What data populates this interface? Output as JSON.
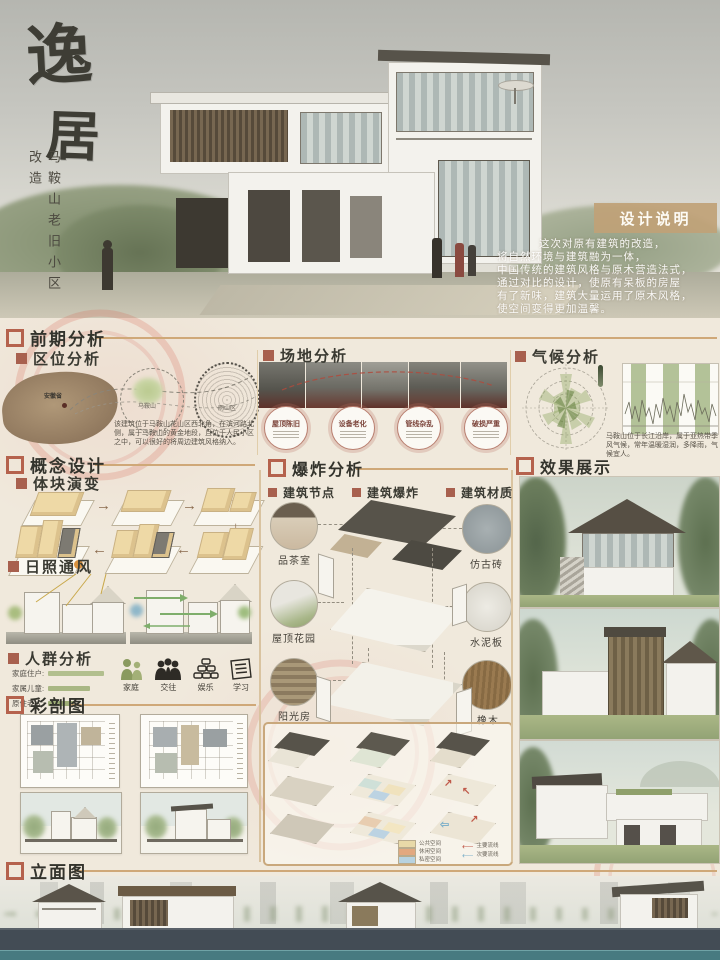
{
  "hero": {
    "title_chars": [
      "逸",
      "居"
    ],
    "subtitle": "马鞍山老旧小区改造",
    "design_note_title": "设计说明",
    "design_note_lines": [
      "这次对原有建筑的改造，",
      "将自然环境与建筑融为一体，",
      "中国传统的建筑风格与原木营造法式，",
      "通过对比的设计，使原有呆板的房屋",
      "有了新味，建筑大量运用了原木风格，",
      "使空间变得更加温馨。"
    ]
  },
  "sections": {
    "preliminary": {
      "title": "前期分析",
      "location": {
        "title": "区位分析",
        "map_labels": [
          "安徽省",
          "马鞍山",
          "雨山区"
        ],
        "desc": "该建筑位于马鞍山花山区西北角，在滨河路北侧，属于马鞍山的黄金地段，且位于人民小区之中，可以很好的将周边建筑风格纳入。"
      },
      "site": {
        "title": "场地分析",
        "issues": [
          "屋顶陈旧",
          "设备老化",
          "管线杂乱",
          "破损严重"
        ]
      },
      "climate": {
        "title": "气候分析",
        "desc": "马鞍山位于长江沿岸，属于亚热带季风气候，常年温暖湿润，多降雨，气候宜人。"
      }
    },
    "concept": {
      "title": "概念设计",
      "massing": {
        "title": "体块演变",
        "arrows": [
          "→",
          "→",
          "↓",
          "←",
          "←"
        ]
      },
      "sunwind": {
        "title": "日照通风"
      },
      "crowd": {
        "title": "人群分析",
        "bars": [
          {
            "label": "家庭住户:"
          },
          {
            "label": "家属儿童:"
          },
          {
            "label": "原住老人:"
          }
        ],
        "icons": [
          "家庭",
          "交往",
          "娱乐",
          "学习"
        ]
      },
      "colorsection": {
        "title": "彩剖图"
      }
    },
    "explosion": {
      "title": "爆炸分析",
      "columns": [
        "建筑节点",
        "建筑爆炸",
        "建筑材质"
      ],
      "nodes": [
        "品茶室",
        "屋顶花园",
        "阳光房"
      ],
      "materials": [
        "仿古砖",
        "水泥板",
        "橡木"
      ],
      "legend": {
        "swatches": [
          {
            "color": "#e8d9a8",
            "label": "公共空间"
          },
          {
            "color": "#e2a87f",
            "label": "休闲空间"
          },
          {
            "color": "#b7d2e0",
            "label": "私密空间"
          }
        ],
        "arrows": [
          {
            "color": "#c05a4a",
            "label": "主要流线"
          },
          {
            "color": "#7fb1c9",
            "label": "次要流线"
          }
        ]
      }
    },
    "render": {
      "title": "效果展示"
    },
    "elevation": {
      "title": "立面图"
    }
  },
  "colors": {
    "accent_brick": "#b5624d",
    "accent_tan": "#cfa878",
    "note_box": "#c0a177",
    "stamp_red": "#d5604e",
    "ground_band": "#434c55",
    "water_band": "#477a80"
  }
}
